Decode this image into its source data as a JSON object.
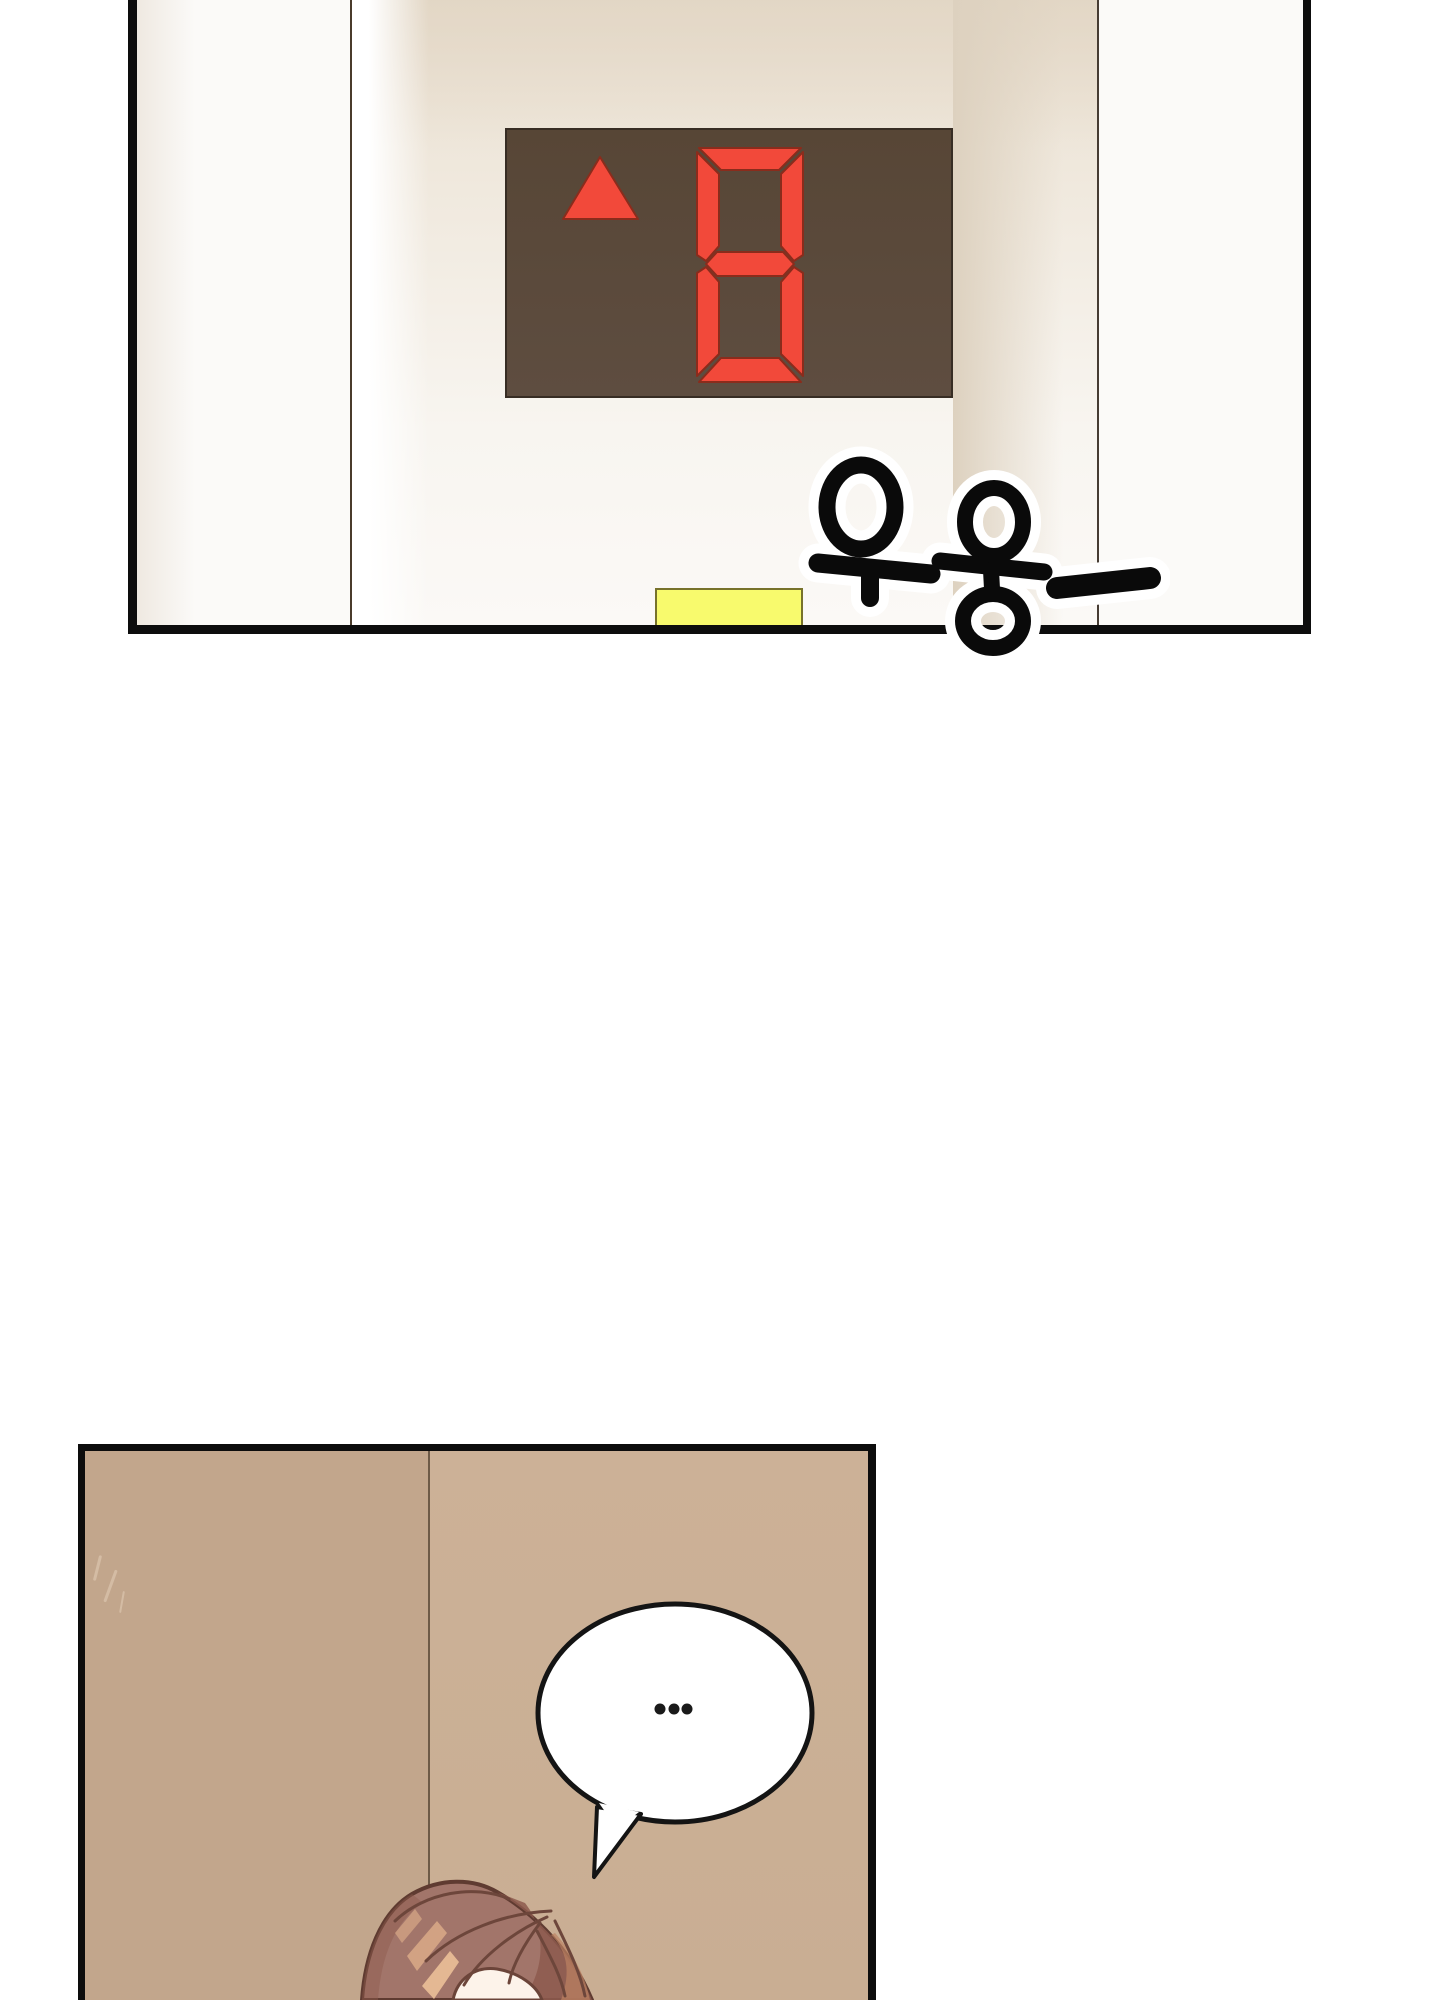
{
  "page": {
    "kind": "webtoon-comic-page",
    "background": "#ffffff"
  },
  "panel_elevator": {
    "sfx_text": "우웅—",
    "floor_display": {
      "value": "8",
      "direction": "up",
      "direction_icon": "up-arrow-icon"
    }
  },
  "panel_hallway": {
    "speech_bubble_text": "..."
  },
  "colors": {
    "frame_border": "#0d0d0d",
    "led_red": "#f2493a",
    "led_outline": "#8a2c1c",
    "panel_brown_top": "#574636",
    "panel_brown_bottom": "#5e4d40",
    "panel_border": "#372d24",
    "button_yellow": "#f8fa6d",
    "button_yellow_border": "#77722b",
    "niche_cream": "#e9dfd0",
    "wall_left": "#c2a68c",
    "wall_right": "#ccb197",
    "wall_line": "#6d5a47",
    "bubble_stroke": "#141414",
    "hair_base": "#a2756a",
    "hair_outline": "#5f3b31",
    "hair_dark": "#8d5b4d",
    "hair_hl1": "#d2a283",
    "hair_hl2": "#e4b893",
    "skin": "#fdf3ea"
  }
}
